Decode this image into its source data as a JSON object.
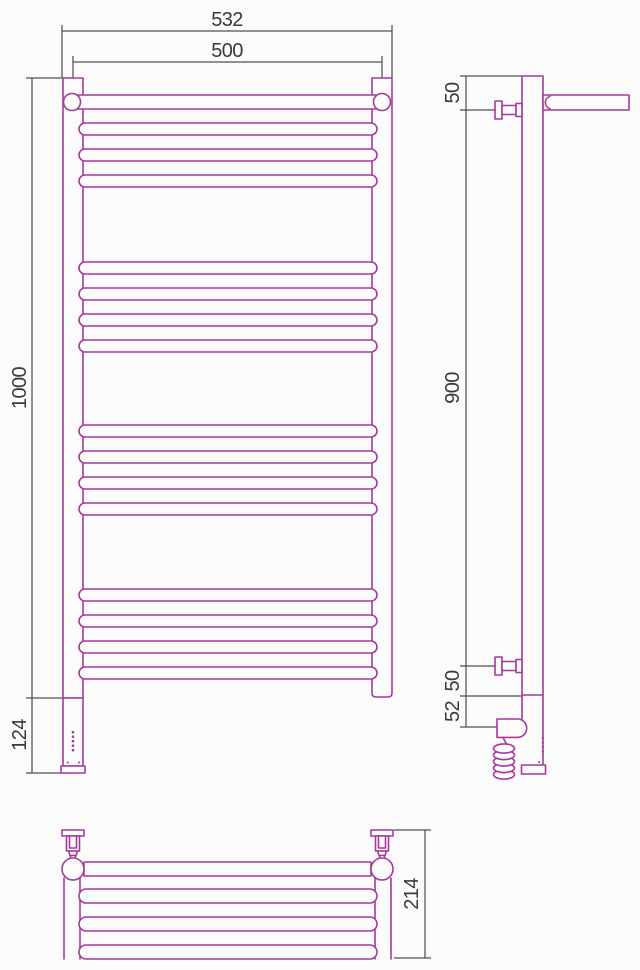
{
  "figure": {
    "kind": "technical orthographic drawing",
    "subject": "ladder-style heated towel rail with electric heating element and wall brackets",
    "views": [
      "front",
      "side",
      "top"
    ]
  },
  "colors": {
    "outline": "#a33b9b",
    "dimension_lines": "#4f4f4f",
    "label_text": "#3a3a3a",
    "background": "#fcfbfc"
  },
  "labels": {
    "front_overall_width": "532",
    "front_mount_width": "500",
    "front_height": "1000",
    "front_heater_section": "124",
    "side_top_offset": "50",
    "side_mount_span": "900",
    "side_bottom_offset": "50",
    "side_heater_offset": "52",
    "top_depth": "214"
  }
}
